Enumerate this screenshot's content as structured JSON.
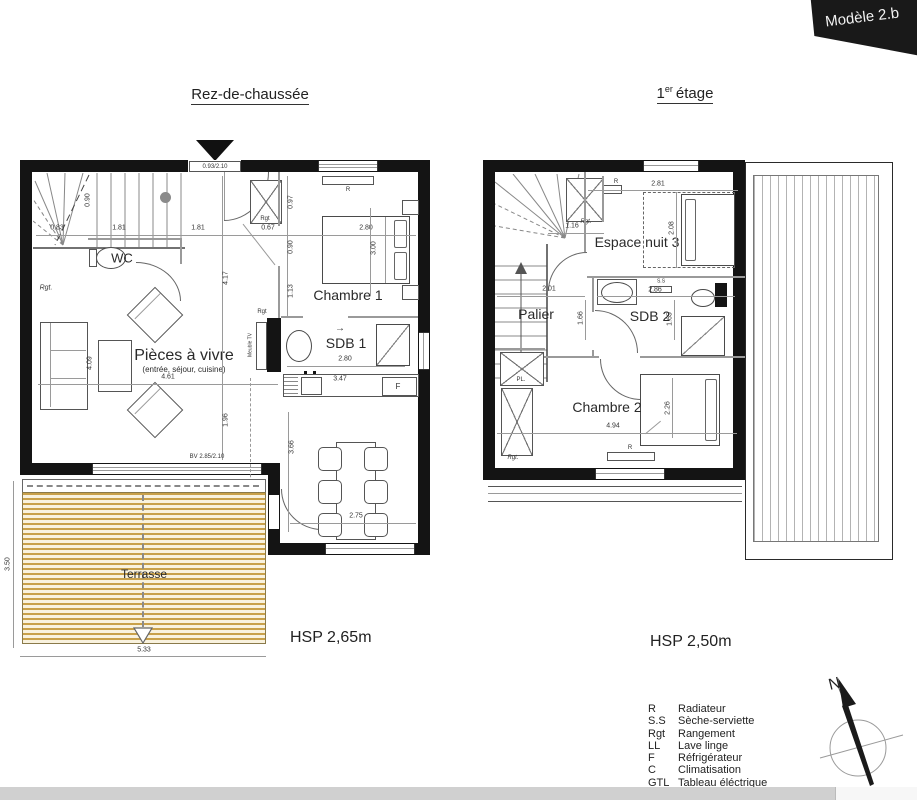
{
  "banner": {
    "label": "Modèle 2.b"
  },
  "ground": {
    "title": "Rez-de-chaussée",
    "hsp": "HSP 2,65m",
    "entrance_door": "0.93/2.10",
    "bay_window": "BV 2.85/2.10",
    "rooms": {
      "wc": "WC",
      "living": "Pièces à vivre",
      "living_sub": "(entrée, séjour, cuisine)",
      "chambre1": "Chambre 1",
      "sdb1": "SDB 1",
      "terrasse": "Terrasse"
    },
    "labels": {
      "rgt_stairs": "Rgt.",
      "rgt_entry": "Rgt",
      "rgt_tv": "Rgt",
      "meuble_tv": "Meuble TV",
      "fridge": "F",
      "radiator": "R",
      "arrow_right": "→"
    },
    "dims": {
      "d090s": "0.90",
      "d083": "0.83",
      "d181a": "1.81",
      "d181b": "1.81",
      "d067": "0.67",
      "d280bed": "2.80",
      "d300": "3.00",
      "d097": "0.97",
      "d090": "0.90",
      "d113": "1.13",
      "d417": "4.17",
      "d409": "4.09",
      "d461": "4.61",
      "d196": "1.96",
      "d280sdb": "2.80",
      "d347": "3.47",
      "d366": "3.66",
      "d275": "2.75",
      "d350": "3.50",
      "d533": "5.33"
    }
  },
  "first": {
    "title_num": "1",
    "title_sup": "er",
    "title_word": "étage",
    "hsp": "HSP 2,50m",
    "rooms": {
      "palier": "Palier",
      "espace_nuit": "Espace nuit 3",
      "sdb2": "SDB 2",
      "chambre2": "Chambre 2"
    },
    "labels": {
      "rgt_top": "Rgt.",
      "pl": "PL.",
      "rgt_bottom": "Rgt.",
      "ss": "S.S",
      "radiator": "R"
    },
    "dims": {
      "d281": "2.81",
      "d208": "2.08",
      "d116": "1.16",
      "d201": "2.01",
      "d166": "1.66",
      "d286": "2.86",
      "d165": "1.65",
      "d494": "4.94",
      "d226": "2.26"
    }
  },
  "legend": {
    "items": [
      {
        "abbr": "R",
        "label": "Radiateur"
      },
      {
        "abbr": "S.S",
        "label": "Sèche-serviette"
      },
      {
        "abbr": "Rgt",
        "label": "Rangement"
      },
      {
        "abbr": "LL",
        "label": "Lave linge"
      },
      {
        "abbr": "F",
        "label": "Réfrigérateur"
      },
      {
        "abbr": "C",
        "label": "Climatisation"
      },
      {
        "abbr": "GTL",
        "label": "Tableau éléctrique"
      }
    ]
  },
  "compass": {
    "north": "N"
  }
}
